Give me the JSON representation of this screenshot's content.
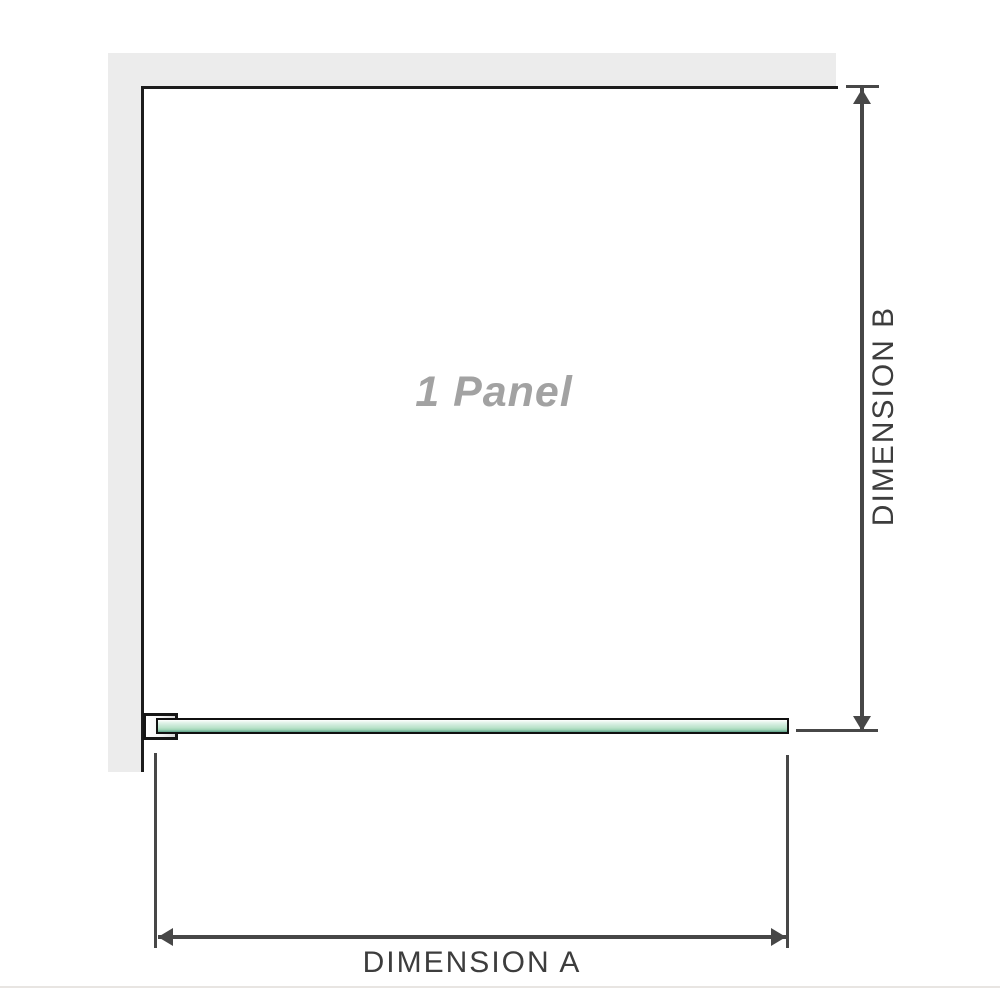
{
  "diagram": {
    "title": "Shower screen panel dimension diagram",
    "panel_label": "1 Panel",
    "dimension_a": {
      "label": "DIMENSION A",
      "orientation": "horizontal"
    },
    "dimension_b": {
      "label": "DIMENSION B",
      "orientation": "vertical"
    },
    "colors": {
      "wall_fill": "#ececec",
      "wall_edge": "#1c1c1c",
      "dimension_line": "#474747",
      "dimension_text": "#3d3d3d",
      "panel_label_text": "#a2a2a2",
      "glass_green_light": "#e6f5ec",
      "glass_green_mid": "#b9e2c9",
      "glass_green_dark": "#68a88f",
      "glass_border": "#101010",
      "bottom_divider": "#e8e5e2"
    }
  }
}
